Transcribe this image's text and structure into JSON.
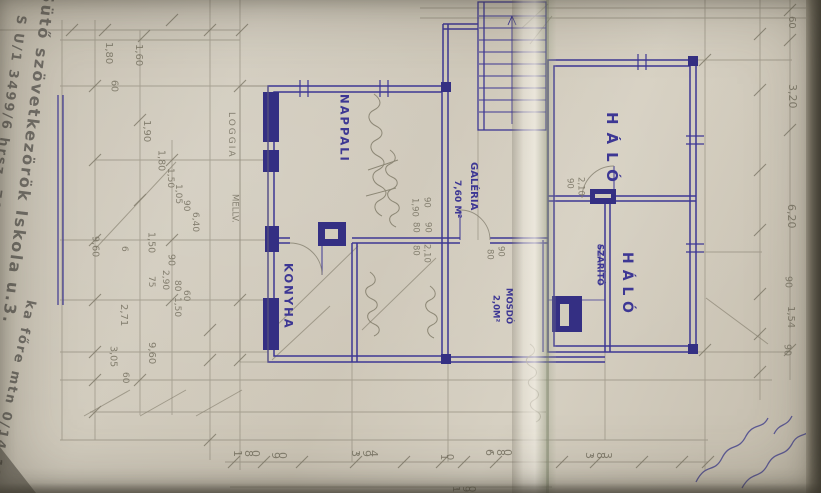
{
  "colors": {
    "ink": "#3d3794",
    "pencil": "#7d7868",
    "paper": "#cdc6b7"
  },
  "handwriting": {
    "line1": "Sütő szövetkezörök Iskola u.3.",
    "line2": "S U/1 3499/6 hrsz. 705-M²",
    "line3": "ka főre mtn 0/14-120"
  },
  "labels": [
    {
      "id": "room-nappali",
      "text": "NAPPALI",
      "x": 338,
      "y": 94,
      "size": 11.5,
      "cls": "ink room",
      "mode": "v"
    },
    {
      "id": "room-konyha",
      "text": "KONYHA",
      "x": 282,
      "y": 263,
      "size": 11.5,
      "cls": "ink room",
      "mode": "v"
    },
    {
      "id": "room-halo-1",
      "text": "HÁLÓ",
      "x": 604,
      "y": 112,
      "size": 15,
      "cls": "ink room",
      "mode": "v",
      "ls": 8
    },
    {
      "id": "room-halo-2",
      "text": "HÁLÓ",
      "x": 620,
      "y": 252,
      "size": 14,
      "cls": "ink room",
      "mode": "v",
      "ls": 6
    },
    {
      "id": "room-szarito",
      "text": "SZÁRÍTÓ",
      "x": 595,
      "y": 244,
      "size": 8.5,
      "cls": "ink",
      "mode": "v",
      "strike": true
    },
    {
      "id": "room-galeria",
      "text": "GALÉRIA",
      "x": 468,
      "y": 162,
      "size": 10,
      "cls": "ink",
      "mode": "v"
    },
    {
      "id": "room-galeria-area",
      "text": "7,60 M²",
      "x": 452,
      "y": 180,
      "size": 9,
      "cls": "ink",
      "mode": "v"
    },
    {
      "id": "room-mosdo",
      "text": "MOSDÓ",
      "x": 504,
      "y": 288,
      "size": 8.5,
      "cls": "ink",
      "mode": "v"
    },
    {
      "id": "room-mosdo-area",
      "text": "2,0M²",
      "x": 491,
      "y": 295,
      "size": 8.5,
      "cls": "ink",
      "mode": "v"
    },
    {
      "id": "room-loggia",
      "text": "LOGGIA",
      "x": 226,
      "y": 112,
      "size": 9,
      "cls": "pencil",
      "mode": "v",
      "ls": 2
    },
    {
      "id": "room-loggia-mellv",
      "text": "MELLV.",
      "x": 230,
      "y": 194,
      "size": 8.5,
      "cls": "pencil",
      "mode": "v"
    },
    {
      "id": "dim-right-1",
      "text": "60",
      "x": 786,
      "y": 16,
      "size": 10,
      "cls": "pencil",
      "mode": "v"
    },
    {
      "id": "dim-right-2",
      "text": "3,20",
      "x": 787,
      "y": 84,
      "size": 11,
      "cls": "pencil",
      "mode": "v"
    },
    {
      "id": "dim-right-3",
      "text": "6,20",
      "x": 786,
      "y": 204,
      "size": 11,
      "cls": "pencil",
      "mode": "v"
    },
    {
      "id": "dim-right-4",
      "text": "90",
      "x": 783,
      "y": 276,
      "size": 9.5,
      "cls": "pencil",
      "mode": "v"
    },
    {
      "id": "dim-right-5",
      "text": "1,54",
      "x": 785,
      "y": 306,
      "size": 10,
      "cls": "pencil",
      "mode": "v"
    },
    {
      "id": "dim-right-6",
      "text": "90",
      "x": 782,
      "y": 344,
      "size": 9.5,
      "cls": "pencil",
      "mode": "v"
    },
    {
      "id": "dim-bottom-1",
      "text": "1,80",
      "x": 234,
      "y": 448,
      "size": 11,
      "cls": "pencil",
      "mode": "h"
    },
    {
      "id": "dim-bottom-2",
      "text": "90",
      "x": 272,
      "y": 450,
      "size": 11,
      "cls": "pencil",
      "mode": "h"
    },
    {
      "id": "dim-bottom-3",
      "text": "3,94",
      "x": 352,
      "y": 448,
      "size": 11,
      "cls": "pencil",
      "mode": "h"
    },
    {
      "id": "dim-bottom-4",
      "text": "10",
      "x": 440,
      "y": 452,
      "size": 10,
      "cls": "pencil",
      "mode": "h"
    },
    {
      "id": "dim-bottom-5",
      "text": "6,80",
      "x": 486,
      "y": 447,
      "size": 11,
      "cls": "pencil",
      "mode": "h"
    },
    {
      "id": "dim-bottom-6",
      "text": "3,83",
      "x": 586,
      "y": 450,
      "size": 11,
      "cls": "pencil",
      "mode": "h"
    },
    {
      "id": "dim-bottom-7",
      "text": "1,90",
      "x": 452,
      "y": 484,
      "size": 10,
      "cls": "pencil",
      "mode": "h"
    },
    {
      "id": "dim-left-1",
      "text": "1,80",
      "x": 103,
      "y": 42,
      "size": 10,
      "cls": "pencil",
      "mode": "v"
    },
    {
      "id": "dim-left-2",
      "text": "60",
      "x": 109,
      "y": 80,
      "size": 9.5,
      "cls": "pencil",
      "mode": "v"
    },
    {
      "id": "dim-left-3",
      "text": "1,60",
      "x": 133,
      "y": 44,
      "size": 10,
      "cls": "pencil",
      "mode": "v"
    },
    {
      "id": "dim-left-4",
      "text": "1,90",
      "x": 141,
      "y": 120,
      "size": 10,
      "cls": "pencil",
      "mode": "v"
    },
    {
      "id": "dim-left-5",
      "text": "1,80",
      "x": 156,
      "y": 150,
      "size": 9.5,
      "cls": "pencil",
      "mode": "v"
    },
    {
      "id": "dim-left-6",
      "text": "1,50",
      "x": 165,
      "y": 168,
      "size": 9,
      "cls": "pencil",
      "mode": "v"
    },
    {
      "id": "dim-left-7",
      "text": "1,05",
      "x": 173,
      "y": 184,
      "size": 9,
      "cls": "pencil",
      "mode": "v"
    },
    {
      "id": "dim-left-8",
      "text": "90",
      "x": 181,
      "y": 200,
      "size": 9,
      "cls": "pencil",
      "mode": "v"
    },
    {
      "id": "dim-left-9",
      "text": "6,40",
      "x": 190,
      "y": 212,
      "size": 9,
      "cls": "pencil",
      "mode": "v"
    },
    {
      "id": "dim-left-10",
      "text": "9,60",
      "x": 90,
      "y": 236,
      "size": 9.5,
      "cls": "pencil",
      "mode": "v"
    },
    {
      "id": "dim-left-11",
      "text": "6",
      "x": 119,
      "y": 246,
      "size": 9,
      "cls": "pencil",
      "mode": "v"
    },
    {
      "id": "dim-left-12",
      "text": "1,50",
      "x": 146,
      "y": 232,
      "size": 9.5,
      "cls": "pencil",
      "mode": "v"
    },
    {
      "id": "dim-left-13",
      "text": "90",
      "x": 166,
      "y": 254,
      "size": 9.5,
      "cls": "pencil",
      "mode": "v"
    },
    {
      "id": "dim-left-14",
      "text": "2,90",
      "x": 160,
      "y": 270,
      "size": 9,
      "cls": "pencil",
      "mode": "v"
    },
    {
      "id": "dim-left-15",
      "text": "80",
      "x": 172,
      "y": 280,
      "size": 9,
      "cls": "pencil",
      "mode": "v"
    },
    {
      "id": "dim-left-16",
      "text": "60",
      "x": 181,
      "y": 290,
      "size": 9,
      "cls": "pencil",
      "mode": "v"
    },
    {
      "id": "dim-left-17",
      "text": "75",
      "x": 146,
      "y": 276,
      "size": 9,
      "cls": "pencil",
      "mode": "v"
    },
    {
      "id": "dim-left-18",
      "text": "1,50",
      "x": 172,
      "y": 297,
      "size": 9,
      "cls": "pencil",
      "mode": "v"
    },
    {
      "id": "dim-left-19",
      "text": "2,71",
      "x": 118,
      "y": 304,
      "size": 10,
      "cls": "pencil",
      "mode": "v"
    },
    {
      "id": "dim-left-20",
      "text": "9,60",
      "x": 146,
      "y": 342,
      "size": 10,
      "cls": "pencil",
      "mode": "v"
    },
    {
      "id": "dim-left-21",
      "text": "3,05",
      "x": 108,
      "y": 346,
      "size": 9.5,
      "cls": "pencil",
      "mode": "v"
    },
    {
      "id": "dim-left-22",
      "text": "60",
      "x": 120,
      "y": 372,
      "size": 9,
      "cls": "pencil",
      "mode": "v"
    },
    {
      "id": "dim-door-1",
      "text": "1,90",
      "x": 410,
      "y": 198,
      "size": 8.5,
      "cls": "pencil",
      "mode": "v"
    },
    {
      "id": "dim-door-2",
      "text": "90",
      "x": 422,
      "y": 197,
      "size": 8.5,
      "cls": "pencil",
      "mode": "v"
    },
    {
      "id": "dim-door-3",
      "text": "80",
      "x": 411,
      "y": 222,
      "size": 8.5,
      "cls": "pencil",
      "mode": "v"
    },
    {
      "id": "dim-door-4",
      "text": "90",
      "x": 423,
      "y": 222,
      "size": 8.5,
      "cls": "pencil",
      "mode": "v"
    },
    {
      "id": "dim-door-5",
      "text": "80",
      "x": 411,
      "y": 245,
      "size": 8.5,
      "cls": "pencil",
      "mode": "v"
    },
    {
      "id": "dim-door-6",
      "text": "2,10",
      "x": 422,
      "y": 244,
      "size": 8.5,
      "cls": "pencil",
      "mode": "v"
    },
    {
      "id": "dim-door-7",
      "text": "90",
      "x": 565,
      "y": 178,
      "size": 8.5,
      "cls": "pencil",
      "mode": "v"
    },
    {
      "id": "dim-door-8",
      "text": "2,10",
      "x": 576,
      "y": 177,
      "size": 8.5,
      "cls": "pencil",
      "mode": "v"
    },
    {
      "id": "dim-door-9",
      "text": "80",
      "x": 485,
      "y": 249,
      "size": 8.5,
      "cls": "pencil",
      "mode": "v"
    },
    {
      "id": "dim-door-10",
      "text": "90",
      "x": 496,
      "y": 246,
      "size": 8.5,
      "cls": "pencil",
      "mode": "v"
    }
  ]
}
